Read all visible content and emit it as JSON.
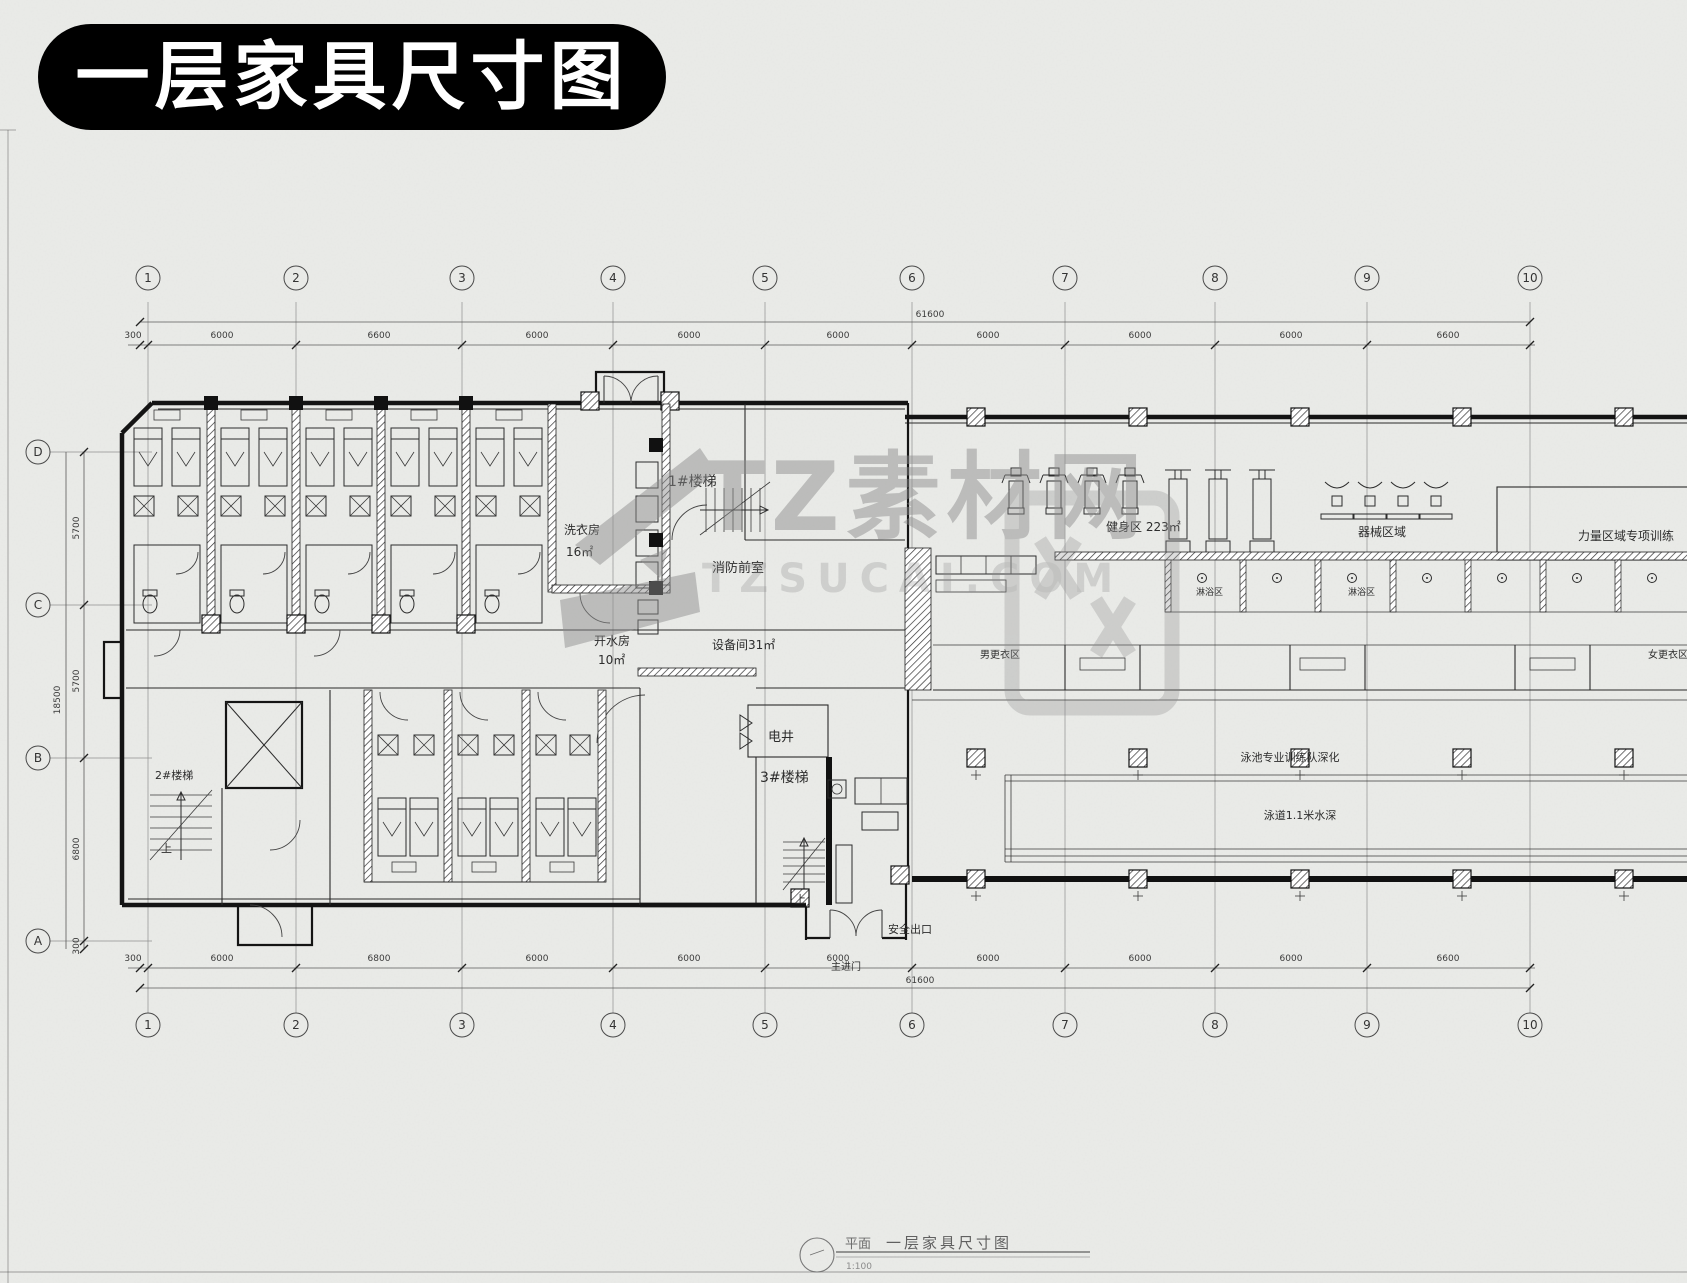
{
  "title_badge": {
    "text": "一层家具尺寸图",
    "bg": "#000000",
    "fg": "#ffffff"
  },
  "watermark": {
    "brand": "TZ素材网",
    "domain": "TZSUCAI.COM",
    "color": "#8c8c8c"
  },
  "grid": {
    "columns": [
      {
        "label": "1",
        "x": 148
      },
      {
        "label": "2",
        "x": 296
      },
      {
        "label": "3",
        "x": 462
      },
      {
        "label": "4",
        "x": 613
      },
      {
        "label": "5",
        "x": 765
      },
      {
        "label": "6",
        "x": 912
      },
      {
        "label": "7",
        "x": 1065
      },
      {
        "label": "8",
        "x": 1215
      },
      {
        "label": "9",
        "x": 1367
      },
      {
        "label": "10",
        "x": 1530
      }
    ],
    "rows": [
      {
        "label": "D",
        "y": 452
      },
      {
        "label": "C",
        "y": 605
      },
      {
        "label": "B",
        "y": 758
      },
      {
        "label": "A",
        "y": 941
      }
    ]
  },
  "dimensions": {
    "tick_xs": [
      140,
      148,
      296,
      462,
      613,
      765,
      912,
      1065,
      1215,
      1367,
      1530
    ],
    "left_tick_ys": [
      452,
      605,
      758,
      941,
      949
    ],
    "top": {
      "total": "61600",
      "total_x": 930,
      "total_y": 317,
      "total_line_y": 322,
      "seg_line_y": 345,
      "seg_text_y": 338,
      "segments": [
        {
          "v": "300",
          "x": 133
        },
        {
          "v": "6000",
          "x": 222
        },
        {
          "v": "6600",
          "x": 379
        },
        {
          "v": "6000",
          "x": 537
        },
        {
          "v": "6000",
          "x": 689
        },
        {
          "v": "6000",
          "x": 838
        },
        {
          "v": "6000",
          "x": 988
        },
        {
          "v": "6000",
          "x": 1140
        },
        {
          "v": "6000",
          "x": 1291
        },
        {
          "v": "6600",
          "x": 1448
        }
      ]
    },
    "bottom": {
      "total": "61600",
      "total_x": 920,
      "total_y": 983,
      "total_line_y": 988,
      "seg_line_y": 968,
      "seg_text_y": 961,
      "segments": [
        {
          "v": "300",
          "x": 133
        },
        {
          "v": "6000",
          "x": 222
        },
        {
          "v": "6800",
          "x": 379
        },
        {
          "v": "6000",
          "x": 537
        },
        {
          "v": "6000",
          "x": 689
        },
        {
          "v": "6000",
          "x": 838
        },
        {
          "v": "6000",
          "x": 988
        },
        {
          "v": "6000",
          "x": 1140
        },
        {
          "v": "6000",
          "x": 1291
        },
        {
          "v": "6600",
          "x": 1448
        }
      ]
    },
    "left": {
      "total": "18500",
      "total_x": 60,
      "total_y": 700,
      "total_line_x": 66,
      "seg_line_x": 84,
      "seg_text_x": 79,
      "segments": [
        {
          "v": "5700",
          "y": 528
        },
        {
          "v": "5700",
          "y": 681
        },
        {
          "v": "6800",
          "y": 849
        },
        {
          "v": "300",
          "y": 946
        }
      ]
    }
  },
  "rooms": [
    {
      "t": "1#楼梯",
      "x": 668,
      "y": 486,
      "s": 14
    },
    {
      "t": "洗衣房",
      "x": 564,
      "y": 534,
      "s": 12
    },
    {
      "t": "16㎡",
      "x": 566,
      "y": 556,
      "s": 12
    },
    {
      "t": "消防前室",
      "x": 712,
      "y": 572,
      "s": 13
    },
    {
      "t": "开水房",
      "x": 594,
      "y": 645,
      "s": 12
    },
    {
      "t": "10㎡",
      "x": 598,
      "y": 664,
      "s": 12
    },
    {
      "t": "设备间31㎡",
      "x": 712,
      "y": 649,
      "s": 12
    },
    {
      "t": "电井",
      "x": 768,
      "y": 741,
      "s": 13
    },
    {
      "t": "3#楼梯",
      "x": 760,
      "y": 782,
      "s": 14
    },
    {
      "t": "2#楼梯",
      "x": 155,
      "y": 779,
      "s": 11
    },
    {
      "t": "上",
      "x": 795,
      "y": 903,
      "s": 11
    },
    {
      "t": "上",
      "x": 161,
      "y": 852,
      "s": 11
    },
    {
      "t": "安全出口",
      "x": 888,
      "y": 933,
      "s": 11
    },
    {
      "t": "主进门",
      "x": 831,
      "y": 970,
      "s": 10
    },
    {
      "t": "健身区 223㎡",
      "x": 1106,
      "y": 531,
      "s": 12
    },
    {
      "t": "器械区域",
      "x": 1358,
      "y": 536,
      "s": 12
    },
    {
      "t": "力量区域专项训练",
      "x": 1578,
      "y": 540,
      "s": 12
    },
    {
      "t": "男更衣区",
      "x": 980,
      "y": 658,
      "s": 10
    },
    {
      "t": "淋浴区",
      "x": 1196,
      "y": 595,
      "s": 9
    },
    {
      "t": "淋浴区",
      "x": 1348,
      "y": 595,
      "s": 9
    },
    {
      "t": "女更衣区",
      "x": 1648,
      "y": 658,
      "s": 10
    },
    {
      "t": "泳池专业训练队深化",
      "x": 1290,
      "y": 761,
      "s": 11,
      "a": "middle"
    },
    {
      "t": "泳道1.1米水深",
      "x": 1300,
      "y": 819,
      "s": 11,
      "a": "middle"
    }
  ],
  "titleblock": {
    "prefix": "平面",
    "name": "一层家具尺寸图",
    "scale": "1:100"
  }
}
